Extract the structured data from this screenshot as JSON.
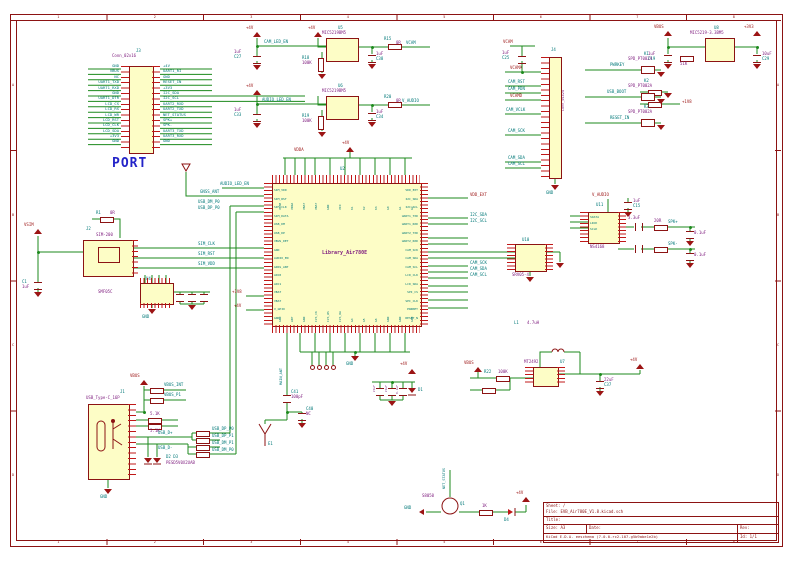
{
  "palette": {
    "frame": "#8c1313",
    "wire": "#1d8a1d",
    "component_fill": "#fdfdc6",
    "pin": "#c01818",
    "net_text": "#007878",
    "value_text": "#7d1a7d",
    "power_text": "#9c1414",
    "port_title_blue": "#2323c8"
  },
  "frame": {
    "top_numbers": [
      "1",
      "2",
      "3",
      "4",
      "5",
      "6",
      "7",
      "8"
    ],
    "bottom_numbers": [
      "1",
      "2",
      "3",
      "4",
      "5",
      "6",
      "7",
      "8"
    ],
    "left_letters": [
      "A",
      "B",
      "C",
      "D"
    ],
    "right_letters": [
      "A",
      "B",
      "C",
      "D"
    ]
  },
  "title_block": {
    "sheet": "Sheet: /",
    "file": "File: EVB_Air780E_V1.8.kicad.sch",
    "title_label": "Title:",
    "size_label": "Size: A3",
    "date_label": "Date:",
    "tool": "KiCad E.D.A.  eeschema (7.0.0-rc2-107-g5b9abe1e2b)",
    "rev_label": "Rev:",
    "id_label": "Id: 1/1"
  },
  "labels": {
    "gnd": "GND",
    "p4v": "+4V",
    "p3v3": "+3V3",
    "p1v8": "+1V8",
    "vbus": "VBUS",
    "vsim": "VSIM",
    "vcam": "VCAM",
    "vdda": "VDDA",
    "vbat": "VBAT",
    "v_audio": "V_AUDIO",
    "vdd_ext": "VDD_EXT",
    "vcama": "VCAMA",
    "vcamd": "VCAMD",
    "cam_led_en": "CAM_LED_EN",
    "audio_led_en": "AUDIO_LED_EN",
    "gnss_ant": "GNSS_ANT",
    "main_ant": "MAIN_ANT",
    "i2c_sda": "I2C_SDA",
    "i2c_scl": "I2C_SCL",
    "sim_clk": "SIM_CLK",
    "sim_rst": "SIM_RST",
    "sim_vdd": "SIM_VDD",
    "usb_dp_p0": "USB_DP_P0",
    "usb_dm_p0": "USB_DM_P0",
    "usb_dp_p1": "USB_DP_P1",
    "usb_dm_p1": "USB_DM_P1",
    "usb_dp": "USB_D+",
    "usb_dm": "USB_D-",
    "vbus_int": "VBUS_INT",
    "vbus_p1": "VBUS_P1",
    "cam_rst": "CAM_RST",
    "cam_pdn": "CAM_PDN",
    "cam_vclk": "CAM_VCLK",
    "cam_sck": "CAM_SCK",
    "cam_sda": "CAM_SDA",
    "cam_scl": "CAM_SCL",
    "pwrkey": "PWRKEY",
    "usb_boot": "USB_BOOT",
    "reset_in": "RESET_IN",
    "net_status": "NET_STATUS",
    "spk_p": "SPK+",
    "spk_m": "SPK-",
    "d1": "D1",
    "d4": "D4"
  },
  "port": {
    "ref": "J3",
    "value": "Conn_02x16",
    "title": "PORT",
    "left_pins": [
      "GND",
      "VBUS",
      "NC",
      "UART1_TXD",
      "UART1_RXD",
      "GND",
      "UART1_DTR",
      "LCD_CS",
      "LCD_RS",
      "LCD_WR",
      "LCD_RST",
      "LCD_CLK",
      "LCD_SDA",
      "+3V3",
      "GND",
      ""
    ],
    "right_pins": [
      "+4V",
      "UART1_RI",
      "GND",
      "RESET_IN",
      "+3V3",
      "I2C_SDA",
      "I2C_SCL",
      "UART2_RXD",
      "UART2_TXD",
      "NET_STATUS",
      "SPK+",
      "SPK-",
      "UART3_TXD",
      "UART3_RXD",
      "GND",
      ""
    ]
  },
  "mcu": {
    "ref": "U2",
    "value": "Library_Air780E",
    "left_pins": [
      "SIM_VDD",
      "SIM_RST",
      "SIM_CLK",
      "SIM_DATA",
      "USB_DM",
      "USB_DP",
      "VBUS_DET",
      "GND",
      "AUDIO_EN",
      "GNSS_ANT",
      "ADC0",
      "ADC1",
      "VBAT",
      "VBAT",
      "V_GPIO",
      "GND"
    ],
    "right_pins": [
      "VDD_EXT",
      "I2C_SDA",
      "I2C_SCL",
      "UART1_TXD",
      "UART1_RXD",
      "UART2_TXD",
      "UART2_RXD",
      "CAM_SCK",
      "CAM_SDA",
      "CAM_SCL",
      "LCD_CLK",
      "LCD_SDA",
      "SPI_CS",
      "SPI_CLK",
      "PWRKEY",
      "RESET_N"
    ],
    "top_pins": [
      "VCAM",
      "VDDA",
      "VBAT",
      "VBAT",
      "GND",
      "VIO",
      "K1",
      "K2",
      "K3",
      "G0",
      "G1",
      "G2"
    ],
    "bottom_pins": [
      "GND",
      "ANT",
      "GND",
      "I2S_CK",
      "I2S_WS",
      "I2S_DA",
      "G4",
      "G5",
      "G6",
      "GND",
      "GND",
      "GND"
    ]
  },
  "components": {
    "reg_vcam": {
      "ref": "U5",
      "value": "MIC5219BM5"
    },
    "reg_vaudio": {
      "ref": "U6",
      "value": "MIC5219BM5"
    },
    "reg_3v3": {
      "ref": "U8",
      "value": "MIC5219-3.3BM5"
    },
    "dcdc": {
      "ref": "U7",
      "value": "MT2492"
    },
    "inductor": {
      "ref": "L1",
      "value": "4.7uH"
    },
    "esd_ic": {
      "ref": "U10",
      "value": "SRV05-4"
    },
    "amp": {
      "ref": "U11",
      "value": "NS4168",
      "pins": [
        "SDATA",
        "LRCK",
        "SCLK"
      ]
    },
    "cam_conn": {
      "ref": "J4",
      "value": "Conn_01x24"
    },
    "sim": {
      "ref": "J2",
      "value": "SIM-200"
    },
    "sim_esd": {
      "ref": "U4",
      "value": "SMF05C"
    },
    "usb": {
      "ref": "J1",
      "value": "USB_Type-C_16P"
    },
    "usb_esd": {
      "ref": "D2 D3",
      "value": "PESD5V0X2UAB"
    },
    "transistor": {
      "ref": "Q1",
      "value": "S8050"
    },
    "antenna": {
      "ref": "E1"
    },
    "buttons": [
      {
        "ref": "K1",
        "value": "SPD_PT002A"
      },
      {
        "ref": "K2",
        "value": "SPD_PT002A"
      },
      {
        "ref": "K3",
        "value": "SPD_PT002A"
      }
    ]
  },
  "passives": {
    "r1": {
      "ref": "R1",
      "v": "0R"
    },
    "r3": {
      "ref": "R3",
      "v": "5.1K"
    },
    "r4": {
      "ref": "R4",
      "v": "5.1K"
    },
    "r15": {
      "ref": "R15",
      "v": "0R"
    },
    "r16": {
      "ref": "R16",
      "v": "51K"
    },
    "r18": {
      "ref": "R18",
      "v": "100K"
    },
    "r19": {
      "ref": "R19",
      "v": "100K"
    },
    "r20": {
      "ref": "R20",
      "v": "0R"
    },
    "r22": {
      "ref": "R22",
      "v": "100K"
    },
    "r25": {
      "ref": "R25",
      "v": "20R"
    },
    "r27": {
      "ref": "R27",
      "v": "1K"
    },
    "c1": {
      "ref": "C1",
      "v": "1uF"
    },
    "c13": {
      "ref": "C13",
      "v": "0.1uF"
    },
    "c15": {
      "ref": "C15",
      "v": "1uF"
    },
    "c16": {
      "ref": "C16",
      "v": "0.1uF"
    },
    "c19": {
      "ref": "C19",
      "v": "1uF"
    },
    "c21": {
      "ref": "C21",
      "v": "3.3uF"
    },
    "c25": {
      "ref": "C25",
      "v": "1uF"
    },
    "c27": {
      "ref": "C27",
      "v": "1uF"
    },
    "c29": {
      "ref": "C29",
      "v": "10uF"
    },
    "c33": {
      "ref": "C33",
      "v": "1uF"
    },
    "c34": {
      "ref": "C34",
      "v": "1uF"
    },
    "c37": {
      "ref": "C37",
      "v": "22uF"
    },
    "c38": {
      "ref": "C38",
      "v": "1uF"
    },
    "c40": {
      "ref": "C40",
      "v": "NC"
    },
    "c41": {
      "ref": "C41",
      "v": "100pF"
    },
    "bank": {
      "v1": "22uF",
      "v2": "22uF",
      "v3": "0.1uF"
    }
  }
}
